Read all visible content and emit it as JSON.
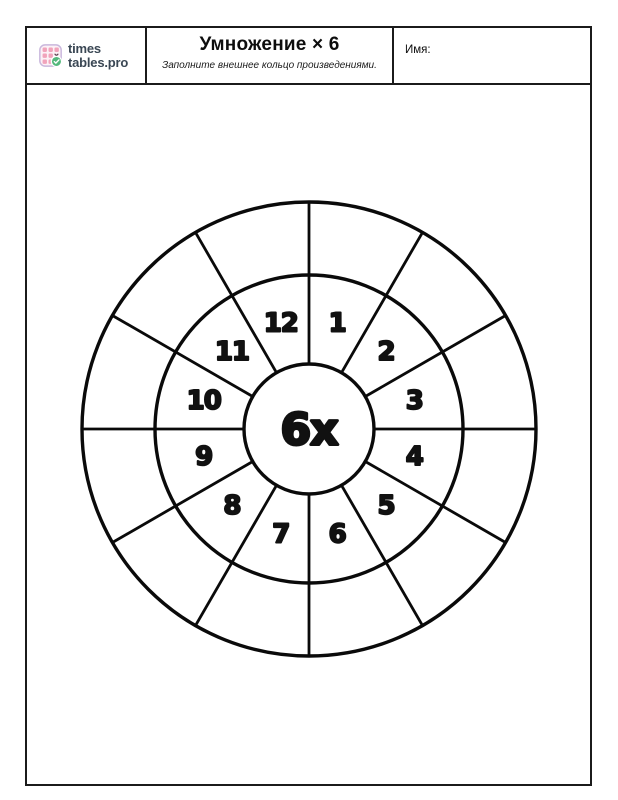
{
  "page": {
    "bg": "#ffffff",
    "ink": "#1b1b1b"
  },
  "header": {
    "logo": {
      "text_line1": "times",
      "text_line2": "tables.pro",
      "text_color": "#3a4754",
      "icon": {
        "bg": "#fcf1f6",
        "border": "#c9b7dc",
        "cell": "#f1a3bb",
        "x_mark": "#5f4150",
        "badge": "#54b87c",
        "check": "#ffffff"
      }
    },
    "title": "Умножение × 6",
    "subtitle": "Заполните внешнее кольцо произведениями.",
    "name_label": "Имя:"
  },
  "wheel": {
    "center_label": "6x",
    "sector_labels": [
      "1",
      "2",
      "3",
      "4",
      "5",
      "6",
      "7",
      "8",
      "9",
      "10",
      "11",
      "12"
    ],
    "outer_values": [
      "",
      "",
      "",
      "",
      "",
      "",
      "",
      "",
      "",
      "",
      "",
      ""
    ],
    "stroke_color": "#0a0a0a",
    "number_color": "#111111"
  }
}
